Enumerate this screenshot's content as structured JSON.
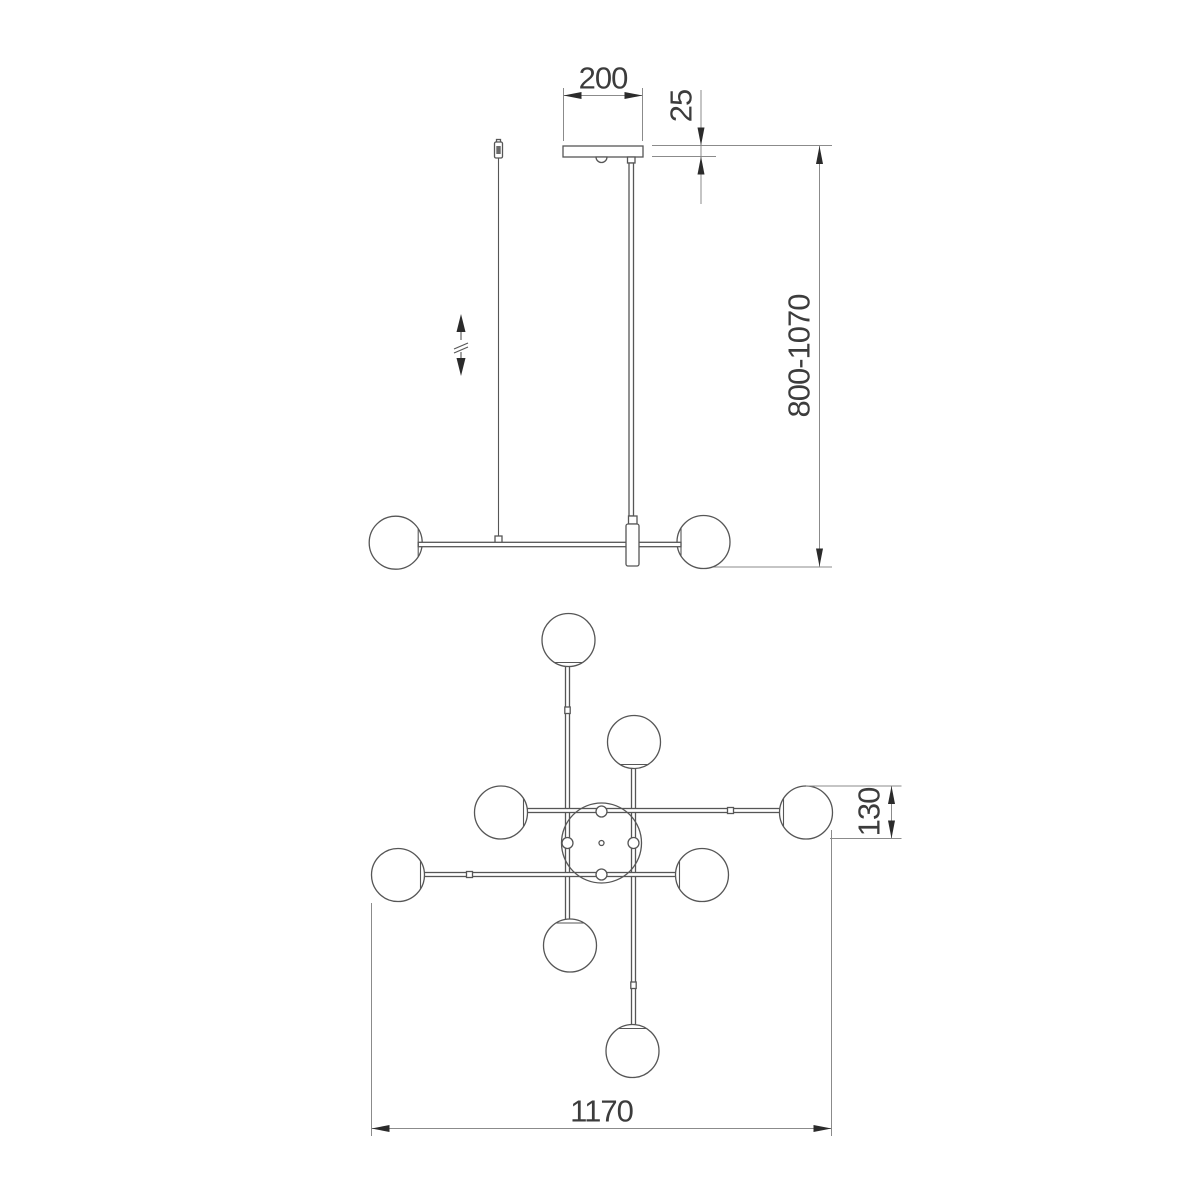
{
  "drawing": {
    "views": {
      "side": {
        "dimensions": {
          "canopy_width": "200",
          "canopy_thickness": "25",
          "suspension_height_range": "800-1070"
        }
      },
      "plan": {
        "dimensions": {
          "globe_diameter": "130",
          "overall_width": "1170"
        }
      }
    },
    "colors": {
      "background": "#ffffff",
      "object_line": "#565656",
      "dimension_line": "#8b8b8b",
      "arrow": "#2b2b2b",
      "label": "#3c3c3c"
    }
  }
}
